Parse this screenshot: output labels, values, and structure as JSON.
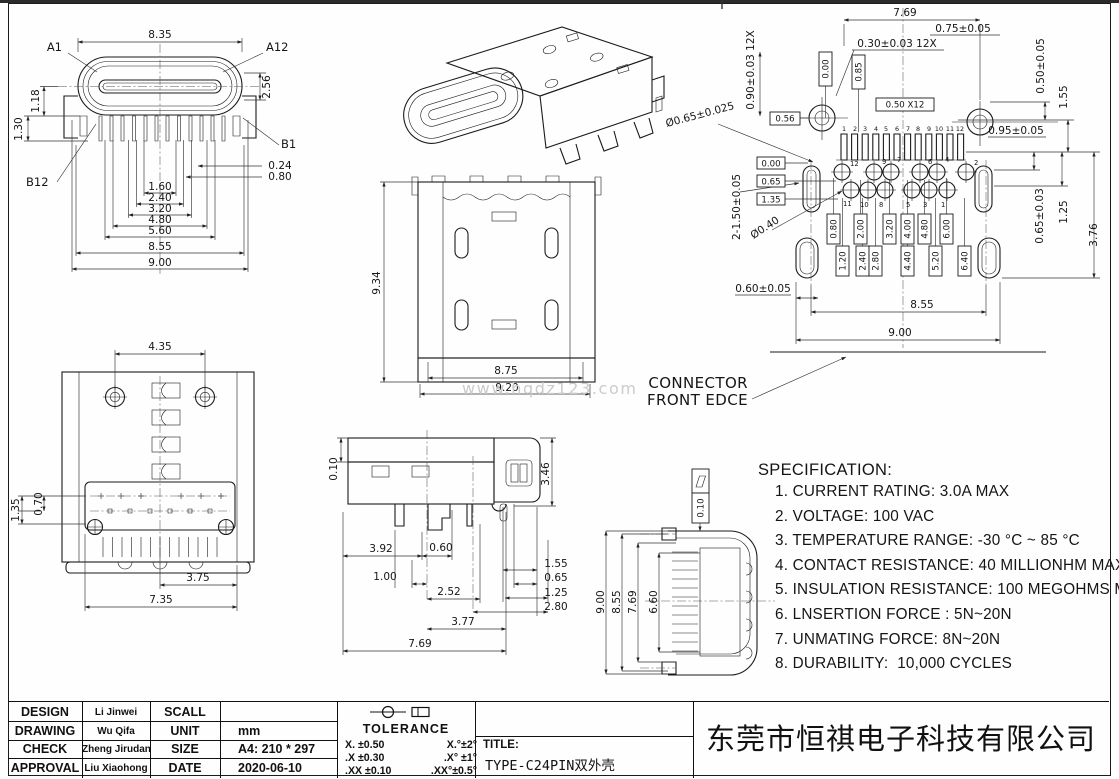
{
  "notes": {
    "watermark": "www.hqdz123.com",
    "front_edge_1": "CONNECTOR",
    "front_edge_2": "FRONT EDCE"
  },
  "views": {
    "front": {
      "labels": {
        "a1": "A1",
        "a12": "A12",
        "b1": "B1",
        "b12": "B12"
      },
      "dims": {
        "d1": "8.35",
        "d2": "2.56",
        "d3": "1.18",
        "d4": "1.30",
        "d5": "0.24",
        "d6": "0.80",
        "d7": "1.60",
        "d8": "2.40",
        "d9": "3.20",
        "d10": "4.80",
        "d11": "5.60",
        "d12": "8.55",
        "d13": "9.00"
      }
    },
    "top": {
      "dims": {
        "d1": "4.35",
        "d2": "1.35",
        "d3": "0.70",
        "d4": "3.75",
        "d5": "7.35"
      }
    },
    "side": {
      "dims": {
        "d1": "9.34",
        "d2": "8.75",
        "d3": "9.20"
      }
    },
    "footprint": {
      "dims": {
        "d1": "7.69",
        "d2": "0.75±0.05",
        "d3": "0.30±0.03 12X",
        "d4": "0.90±0.03 12X",
        "d5": "0.50 X12",
        "d6": "0.56",
        "d7": "0.00",
        "d8": "0.85",
        "d9": "Ø0.65±0.025",
        "d10": "0.50±0.05",
        "d11": "1.55",
        "d12": "0.95±0.05",
        "d13": "0.00",
        "d14": "0.65",
        "d15": "1.35",
        "d16": "2-1.50±0.05",
        "d17": "Ø0.40",
        "d18": "0.65±0.03",
        "d19": "1.25",
        "d20": "3.76",
        "d21": "0.60±0.05",
        "d22": "8.55",
        "d23": "9.00",
        "c1": "0.80",
        "c2": "2.00",
        "c3": "3.20",
        "c4": "4.00",
        "c5": "4.80",
        "c6": "6.00",
        "c7": "1.20",
        "c8": "2.40",
        "c9": "2.80",
        "c10": "4.40",
        "c11": "5.20",
        "c12": "6.40"
      },
      "pad_numbers": [
        "1",
        "2",
        "3",
        "4",
        "5",
        "6",
        "7",
        "8",
        "9",
        "10",
        "11",
        "12"
      ],
      "th_top": [
        "12",
        "9",
        "7",
        "6",
        "4",
        "2"
      ],
      "th_bottom": [
        "11",
        "10",
        "8",
        "5",
        "3",
        "1"
      ]
    },
    "profile": {
      "dims": {
        "d1": "0.10",
        "d2": "3.46",
        "d3": "3.92",
        "d4": "0.60",
        "d5": "1.00",
        "d6": "2.52",
        "d7": "3.77",
        "d8": "7.69",
        "d9": "1.55",
        "d10": "0.65",
        "d11": "1.25",
        "d12": "2.80"
      }
    },
    "rotated": {
      "flatness": "0.10",
      "dims": {
        "d1": "9.00",
        "d2": "8.55",
        "d3": "7.69",
        "d4": "6.60"
      }
    }
  },
  "specification": {
    "title": "SPECIFICATION:",
    "items": [
      "1. CURRENT RATING: 3.0A MAX",
      "2. VOLTAGE: 100 VAC",
      "3. TEMPERATURE RANGE: -30 °C ~ 85 °C",
      "4. CONTACT RESISTANCE: 40 MILLIONHM MAX",
      "5. INSULATION RESISTANCE: 100 MEGOHMS MIN",
      "6. LNSERTION FORCE : 5N~20N",
      "7. UNMATING FORCE: 8N~20N",
      "8. DURABILITY:  10,000 CYCLES"
    ]
  },
  "title_block": {
    "rows": [
      {
        "label": "DESIGN",
        "name": "Li Jinwei",
        "field": "SCALL",
        "value": ""
      },
      {
        "label": "DRAWING",
        "name": "Wu Qifa",
        "field": "UNIT",
        "value": "mm"
      },
      {
        "label": "CHECK",
        "name": "Zheng Jirudan",
        "field": "SIZE",
        "value": "A4: 210 * 297"
      },
      {
        "label": "APPROVAL",
        "name": "Liu Xiaohong",
        "field": "DATE",
        "value": "2020-06-10"
      }
    ],
    "tolerance": {
      "title": "TOLERANCE",
      "rows": [
        {
          "linear": "X.  ±0.50",
          "angular": "X.°±2°"
        },
        {
          "linear": ".X  ±0.30",
          "angular": ".X° ±1°"
        },
        {
          "linear": ".XX ±0.10",
          "angular": ".XX°±0.5°"
        }
      ]
    },
    "title_label": "TITLE:",
    "title_value": "TYPE-C24PIN双外壳",
    "company": "东莞市恒祺电子科技有限公司"
  }
}
